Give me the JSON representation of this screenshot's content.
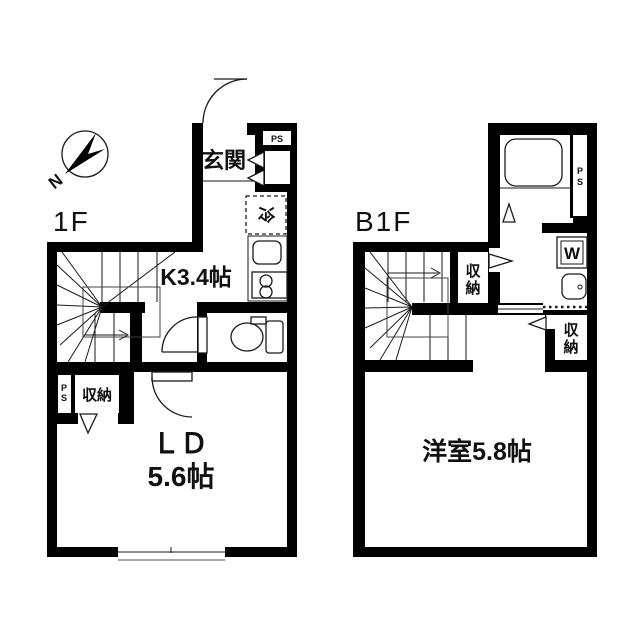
{
  "compass": {
    "north_label": "N"
  },
  "colors": {
    "wall": "#000000",
    "background": "#ffffff",
    "text": "#111111"
  },
  "f1": {
    "label": "1F",
    "entrance_label": "玄関",
    "kitchen_label": "K3.4帖",
    "fridge_label": "冷",
    "ld_label": "ＬＤ",
    "ld_size_label": "5.6帖",
    "storage_label": "収納",
    "ps_top_label": "PS",
    "ps_left_p": "P",
    "ps_left_s": "S"
  },
  "b1": {
    "label": "B1F",
    "room_label": "洋室5.8帖",
    "storage1_c1": "収",
    "storage1_c2": "納",
    "storage2_c1": "収",
    "storage2_c2": "納",
    "washer_label": "W",
    "ps_p": "P",
    "ps_s": "S"
  }
}
